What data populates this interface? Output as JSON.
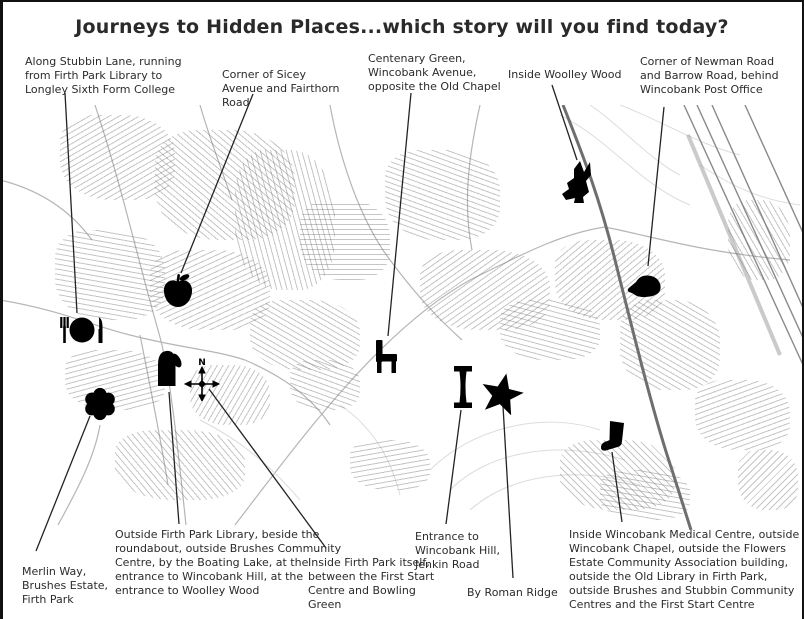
{
  "title": "Journeys to Hidden Places...which story will you find today?",
  "map": {
    "description": "Black and white street map of the Firth Park, Wincobank and Woolley Wood area with story markers",
    "colors": {
      "ink": "#1c1c1c",
      "map_line": "#b5b5b5",
      "dark_road": "#6e6e6e",
      "background": "#ffffff"
    },
    "markers": [
      {
        "name": "meal-icon",
        "depicts": "fork, plate and knife",
        "x": 82,
        "y": 330
      },
      {
        "name": "apple-icon",
        "depicts": "apple with leaf",
        "x": 178,
        "y": 291
      },
      {
        "name": "mitten-icon",
        "depicts": "mitten glove",
        "x": 167,
        "y": 367
      },
      {
        "name": "compass-icon",
        "depicts": "compass rose with N",
        "x": 202,
        "y": 379
      },
      {
        "name": "flower-icon",
        "depicts": "six petal flower",
        "x": 100,
        "y": 404
      },
      {
        "name": "chair-icon",
        "depicts": "chair",
        "x": 386,
        "y": 357
      },
      {
        "name": "column-icon",
        "depicts": "stone column",
        "x": 463,
        "y": 387
      },
      {
        "name": "star-icon",
        "depicts": "five pointed star",
        "x": 502,
        "y": 393
      },
      {
        "name": "fox-icon",
        "depicts": "wild animal",
        "x": 580,
        "y": 182
      },
      {
        "name": "mouse-icon",
        "depicts": "mouse",
        "x": 644,
        "y": 286
      },
      {
        "name": "boot-icon",
        "depicts": "boot",
        "x": 612,
        "y": 438
      }
    ],
    "annotations": [
      {
        "text": "Along Stubbin Lane, running from Firth Park Library to Longley Sixth Form College"
      },
      {
        "text": "Corner of Sicey Avenue and Fairthorn Road"
      },
      {
        "text": "Centenary Green, Wincobank Avenue, opposite the Old Chapel"
      },
      {
        "text": "Inside Woolley Wood"
      },
      {
        "text": "Corner of Newman Road and Barrow Road, behind Wincobank Post Office"
      },
      {
        "text": "Merlin Way, Brushes Estate, Firth Park"
      },
      {
        "text": "Outside Firth Park Library, beside the roundabout, outside Brushes Community Centre, by the Boating Lake, at the entrance to Wincobank Hill, at the entrance to Woolley Wood"
      },
      {
        "text": "Inside Firth Park itself, between the First Start Centre and Bowling Green"
      },
      {
        "text": "Entrance to Wincobank Hill, Jenkin Road"
      },
      {
        "text": "By Roman Ridge"
      },
      {
        "text": "Inside Wincobank Medical Centre, outside Wincobank Chapel, outside the Flowers Estate Community Association building, outside the Old Library in Firth Park, outside Brushes and Stubbin Community Centres and the First Start Centre"
      }
    ],
    "leader_lines": [
      [
        65,
        93,
        77,
        313
      ],
      [
        253,
        94,
        181,
        273
      ],
      [
        411,
        93,
        388,
        336
      ],
      [
        552,
        85,
        577,
        160
      ],
      [
        664,
        107,
        648,
        266
      ],
      [
        36,
        551,
        90,
        416
      ],
      [
        179,
        524,
        169,
        392
      ],
      [
        326,
        548,
        209,
        389
      ],
      [
        446,
        524,
        461,
        410
      ],
      [
        513,
        578,
        503,
        406
      ],
      [
        622,
        522,
        612,
        452
      ]
    ]
  }
}
